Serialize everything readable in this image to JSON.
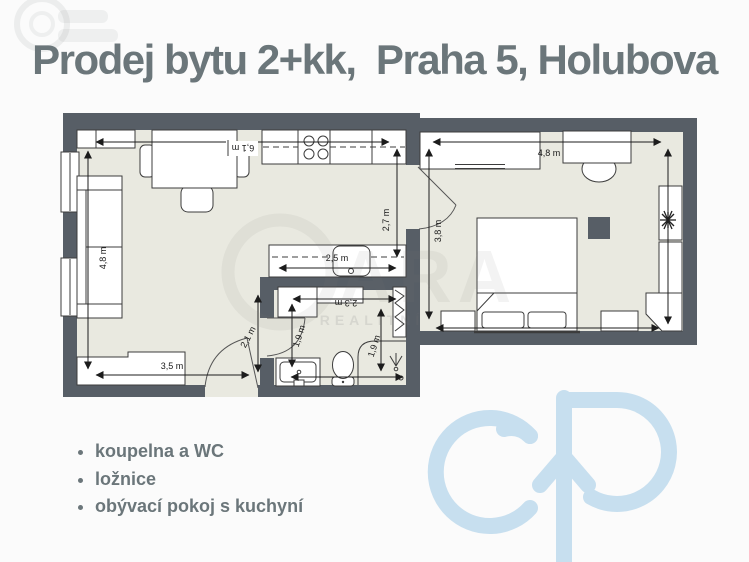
{
  "title": {
    "text": "Prodej bytu 2+kk,  Praha 5, Holubova"
  },
  "features": {
    "items": [
      "koupelna a WC",
      "ložnice",
      "obývací pokoj s kuchyní"
    ]
  },
  "floorplan": {
    "dimensions": {
      "living_top": "6,1 m",
      "living_left": "4,8 m",
      "living_bottom": "3,5 m",
      "kitchen_right": "2,7 m",
      "island": "2,5 m",
      "bath_top": "2,3 m",
      "hall": "2,1 m",
      "bath_left": "1,9 m",
      "bath_right": "1,9 m",
      "bedroom_top": "4,8 m",
      "bedroom_left": "3,8 m"
    },
    "colors": {
      "wall": "#575e66",
      "floor": "#e9e9e0"
    }
  },
  "watermark": {
    "big": "ARA",
    "small": "REALITNÍ"
  },
  "branding": {
    "accent_text_color": "#6b767a",
    "logo_color": "#c7dfef"
  }
}
